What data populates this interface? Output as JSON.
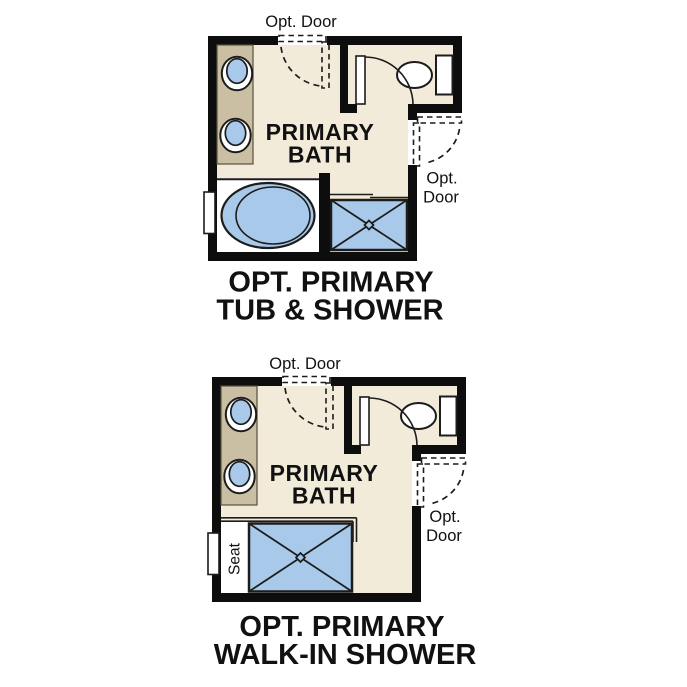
{
  "colors": {
    "wall": "#0d0d0d",
    "outline": "#1c1c1c",
    "floor": "#f2ebda",
    "counter": "#cbbfa3",
    "blue": "#a9c9ea",
    "text": "#111111"
  },
  "plans": {
    "tub_shower": {
      "top_door_label": "Opt. Door",
      "room_label_line1": "PRIMARY",
      "room_label_line2": "BATH",
      "side_door_label_line1": "Opt.",
      "side_door_label_line2": "Door",
      "caption_line1": "OPT. PRIMARY",
      "caption_line2": "TUB & SHOWER"
    },
    "walk_in_shower": {
      "top_door_label": "Opt. Door",
      "room_label_line1": "PRIMARY",
      "room_label_line2": "BATH",
      "side_door_label_line1": "Opt.",
      "side_door_label_line2": "Door",
      "seat_label": "Seat",
      "caption_line1": "OPT. PRIMARY",
      "caption_line2": "WALK-IN SHOWER"
    }
  }
}
